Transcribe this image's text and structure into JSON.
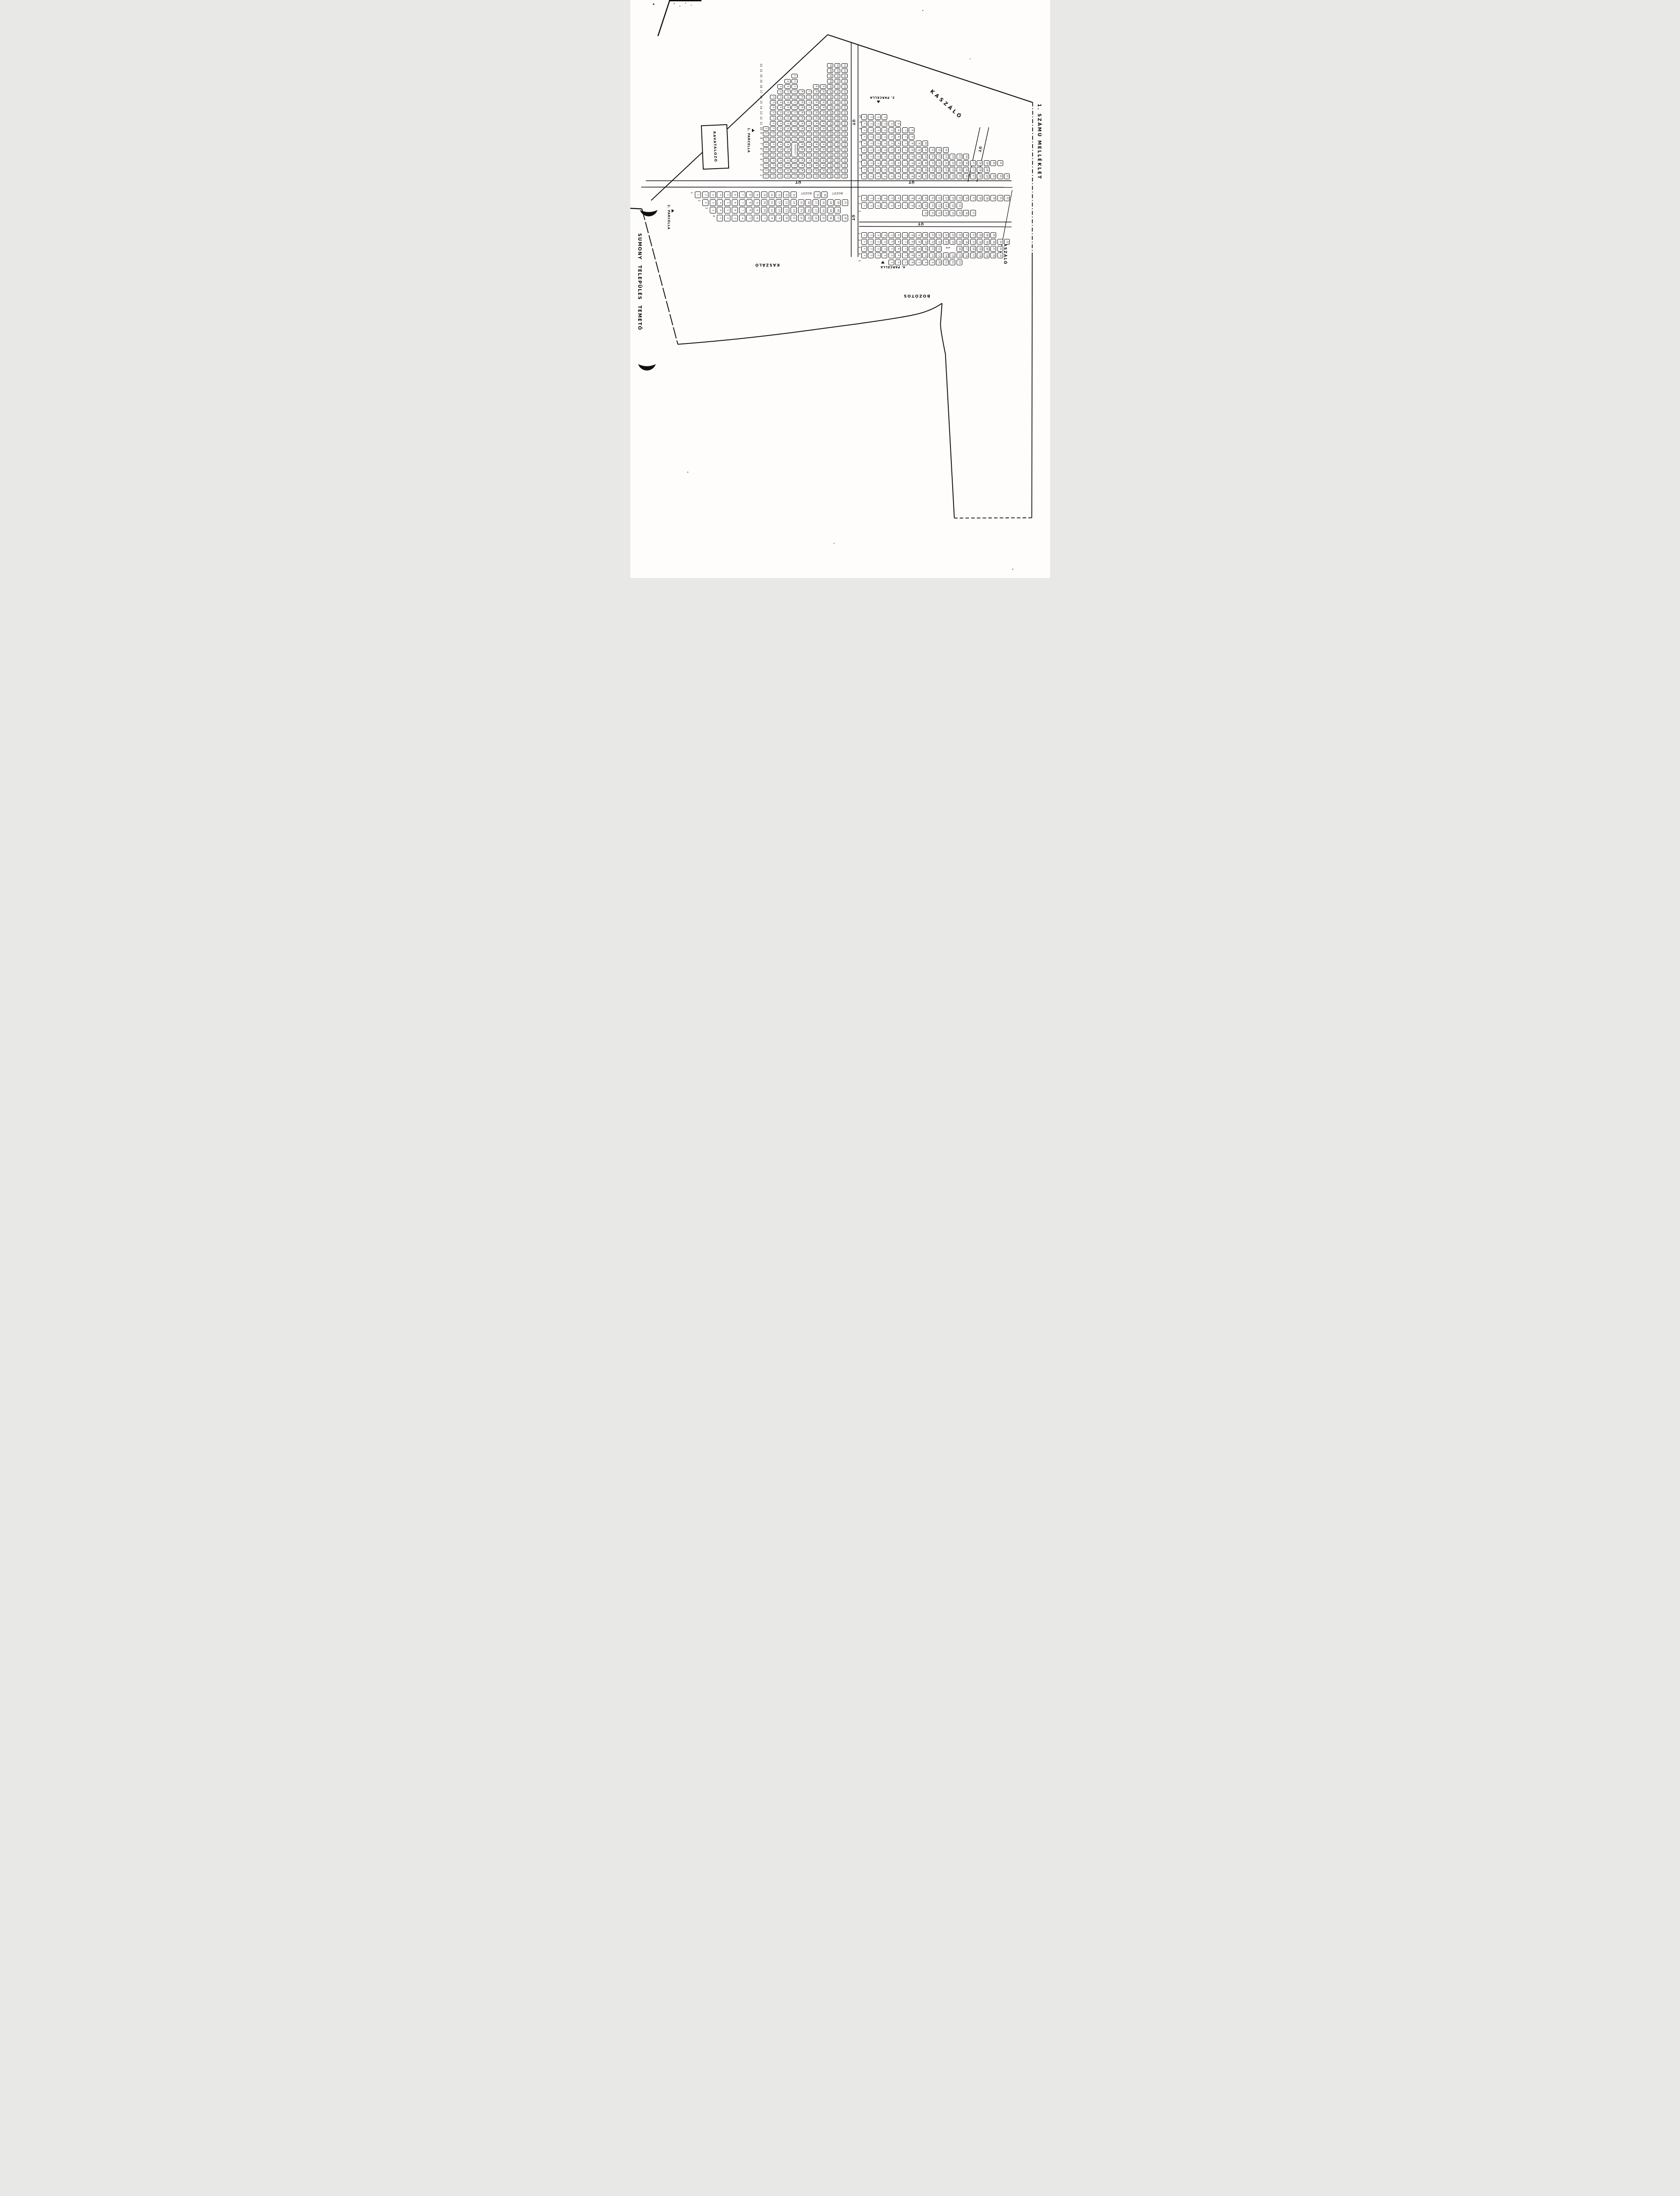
{
  "document": {
    "right_margin_title": "1. SZÁMÚ MELLÉKLET",
    "left_margin_title": "SUMONY TELEPÜLÉS TEMETŐ"
  },
  "labels": {
    "road": "ÚT",
    "meadow": "KASZÁLÓ",
    "bushes": "BOZÓTOS",
    "bush": "BOZÓT",
    "mortuary": "RAVATALOZÓ",
    "cross": "KERESZT",
    "annotation_4a": "≠A"
  },
  "parcels": {
    "p1": {
      "name": "1. PARCELLA",
      "rows": [
        {
          "label": "22",
          "items": [
            {
              "col": 10,
              "nums": [
                10,
                12
              ]
            }
          ]
        },
        {
          "label": "21",
          "items": [
            {
              "col": 10,
              "nums": [
                10,
                12
              ]
            }
          ]
        },
        {
          "label": "20",
          "items": [
            {
              "col": 5,
              "nums": [
                5,
                5
              ]
            },
            {
              "col": 10,
              "nums": [
                10,
                12
              ]
            }
          ]
        },
        {
          "label": "19",
          "items": [
            {
              "col": 4,
              "nums": [
                4,
                5
              ]
            },
            {
              "col": 10,
              "nums": [
                10,
                12
              ]
            }
          ]
        },
        {
          "label": "18",
          "items": [
            {
              "col": 3,
              "nums": [
                3,
                5
              ]
            },
            {
              "col": 8,
              "nums": [
                8,
                12
              ]
            }
          ]
        },
        {
          "label": "17",
          "items": [
            {
              "col": 3,
              "nums": [
                3,
                12
              ]
            }
          ]
        },
        {
          "label": "16",
          "items": [
            {
              "col": 2,
              "nums": [
                2,
                12
              ]
            }
          ]
        },
        {
          "label": "15",
          "items": [
            {
              "col": 2,
              "nums": [
                2,
                12
              ]
            }
          ]
        },
        {
          "label": "14",
          "items": [
            {
              "col": 2,
              "nums": [
                2,
                12
              ]
            }
          ]
        },
        {
          "label": "13",
          "items": [
            {
              "col": 2,
              "nums": [
                2,
                12
              ]
            }
          ]
        },
        {
          "label": "12",
          "items": [
            {
              "col": 2,
              "nums": [
                2,
                12
              ]
            }
          ]
        },
        {
          "label": "11",
          "items": [
            {
              "col": 2,
              "nums": [
                2,
                12
              ]
            }
          ]
        },
        {
          "label": "10",
          "items": [
            {
              "col": 1,
              "nums": [
                1,
                12
              ]
            }
          ]
        },
        {
          "label": "9",
          "items": [
            {
              "col": 1,
              "nums": [
                1,
                12
              ]
            }
          ]
        },
        {
          "label": "8",
          "items": [
            {
              "col": 1,
              "nums": [
                1,
                12
              ]
            }
          ]
        },
        {
          "label": "7",
          "items": [
            {
              "col": 1,
              "nums": [
                1,
                4
              ]
            },
            {
              "col": 5,
              "note": "KERESZT",
              "box": true,
              "tall": 3,
              "rot": 90
            },
            {
              "col": 6,
              "nums": [
                6,
                12
              ]
            }
          ]
        },
        {
          "label": "6",
          "items": [
            {
              "col": 1,
              "nums": [
                1,
                4
              ]
            },
            {
              "col": 6,
              "nums": [
                6,
                12
              ]
            }
          ]
        },
        {
          "label": "5",
          "items": [
            {
              "col": 1,
              "nums": [
                1,
                4
              ]
            },
            {
              "col": 6,
              "nums": [
                6,
                12
              ]
            }
          ]
        },
        {
          "label": "4",
          "items": [
            {
              "col": 1,
              "nums": [
                1,
                12
              ]
            }
          ]
        },
        {
          "label": "3",
          "items": [
            {
              "col": 1,
              "nums": [
                1,
                12
              ]
            }
          ]
        },
        {
          "label": "2",
          "items": [
            {
              "col": 1,
              "nums": [
                1,
                12
              ]
            }
          ]
        },
        {
          "label": "1",
          "items": [
            {
              "col": 1,
              "nums": [
                1,
                12
              ]
            }
          ]
        }
      ]
    },
    "p2": {
      "name": "2. PARCELLA",
      "rows": [
        {
          "label": "1",
          "items": [
            {
              "col": 1,
              "nums": [
                1,
                14
              ]
            },
            {
              "col": 15.4,
              "note": "BOZÓT"
            },
            {
              "col": 17.2,
              "nums": [
                15,
                16
              ]
            },
            {
              "col": 19.6,
              "note": "BOZÓT"
            }
          ]
        },
        {
          "label": "2",
          "items": [
            {
              "col": 2,
              "nums": [
                2,
                21
              ]
            }
          ]
        },
        {
          "label": "3",
          "items": [
            {
              "col": 3,
              "nums": [
                3,
                20
              ]
            }
          ]
        },
        {
          "label": "4",
          "items": [
            {
              "col": 4,
              "nums": [
                1,
                18
              ]
            }
          ]
        }
      ]
    },
    "p3": {
      "name": "3. PARCELLA",
      "rows": [
        {
          "label": "10",
          "items": [
            {
              "col": 1,
              "nums": [
                1,
                4
              ]
            }
          ]
        },
        {
          "label": "9",
          "items": [
            {
              "col": 1,
              "nums": [
                1,
                6
              ]
            }
          ]
        },
        {
          "label": "8",
          "items": [
            {
              "col": 1,
              "nums": [
                1,
                8
              ]
            }
          ]
        },
        {
          "label": "7",
          "items": [
            {
              "col": 1,
              "nums": [
                1,
                8
              ]
            }
          ]
        },
        {
          "label": "6",
          "items": [
            {
              "col": 1,
              "nums": [
                1,
                10
              ]
            }
          ]
        },
        {
          "label": "5",
          "items": [
            {
              "col": 1,
              "nums": [
                1,
                13
              ]
            }
          ]
        },
        {
          "label": "4",
          "items": [
            {
              "col": 1,
              "nums": [
                1,
                16
              ]
            }
          ]
        },
        {
          "label": "3",
          "items": [
            {
              "col": 1,
              "nums": [
                1,
                21
              ]
            }
          ]
        },
        {
          "label": "2",
          "items": [
            {
              "col": 1,
              "nums": [
                1,
                19
              ]
            }
          ]
        },
        {
          "label": "1",
          "items": [
            {
              "col": 1,
              "nums": [
                1,
                22
              ]
            }
          ]
        }
      ]
    },
    "p4": {
      "name": "4. PARCELLA",
      "upper_rows": [
        {
          "label": "1",
          "items": [
            {
              "col": 1,
              "nums": [
                1,
                22
              ]
            }
          ]
        },
        {
          "label": "2",
          "items": [
            {
              "col": 1,
              "nums": [
                1,
                15
              ]
            }
          ]
        },
        {
          "label": "3",
          "items": [
            {
              "col": 10,
              "nums": [
                10,
                17
              ]
            }
          ]
        }
      ],
      "lower_rows": [
        {
          "label": "1",
          "items": [
            {
              "col": 1,
              "nums": [
                1,
                20
              ]
            }
          ]
        },
        {
          "label": "2",
          "items": [
            {
              "col": 1,
              "nums": [
                1,
                22
              ]
            }
          ]
        },
        {
          "label": "3",
          "items": [
            {
              "col": 1,
              "nums": [
                1,
                12
              ]
            },
            {
              "col": 13.4,
              "note": "≠A"
            },
            {
              "col": 15,
              "nums": [
                16,
                22
              ]
            }
          ]
        },
        {
          "label": "4",
          "items": [
            {
              "col": 1,
              "nums": [
                1,
                21
              ]
            }
          ]
        },
        {
          "label": "5",
          "items": [
            {
              "col": 5,
              "nums": [
                3,
                13
              ]
            }
          ]
        }
      ]
    }
  }
}
